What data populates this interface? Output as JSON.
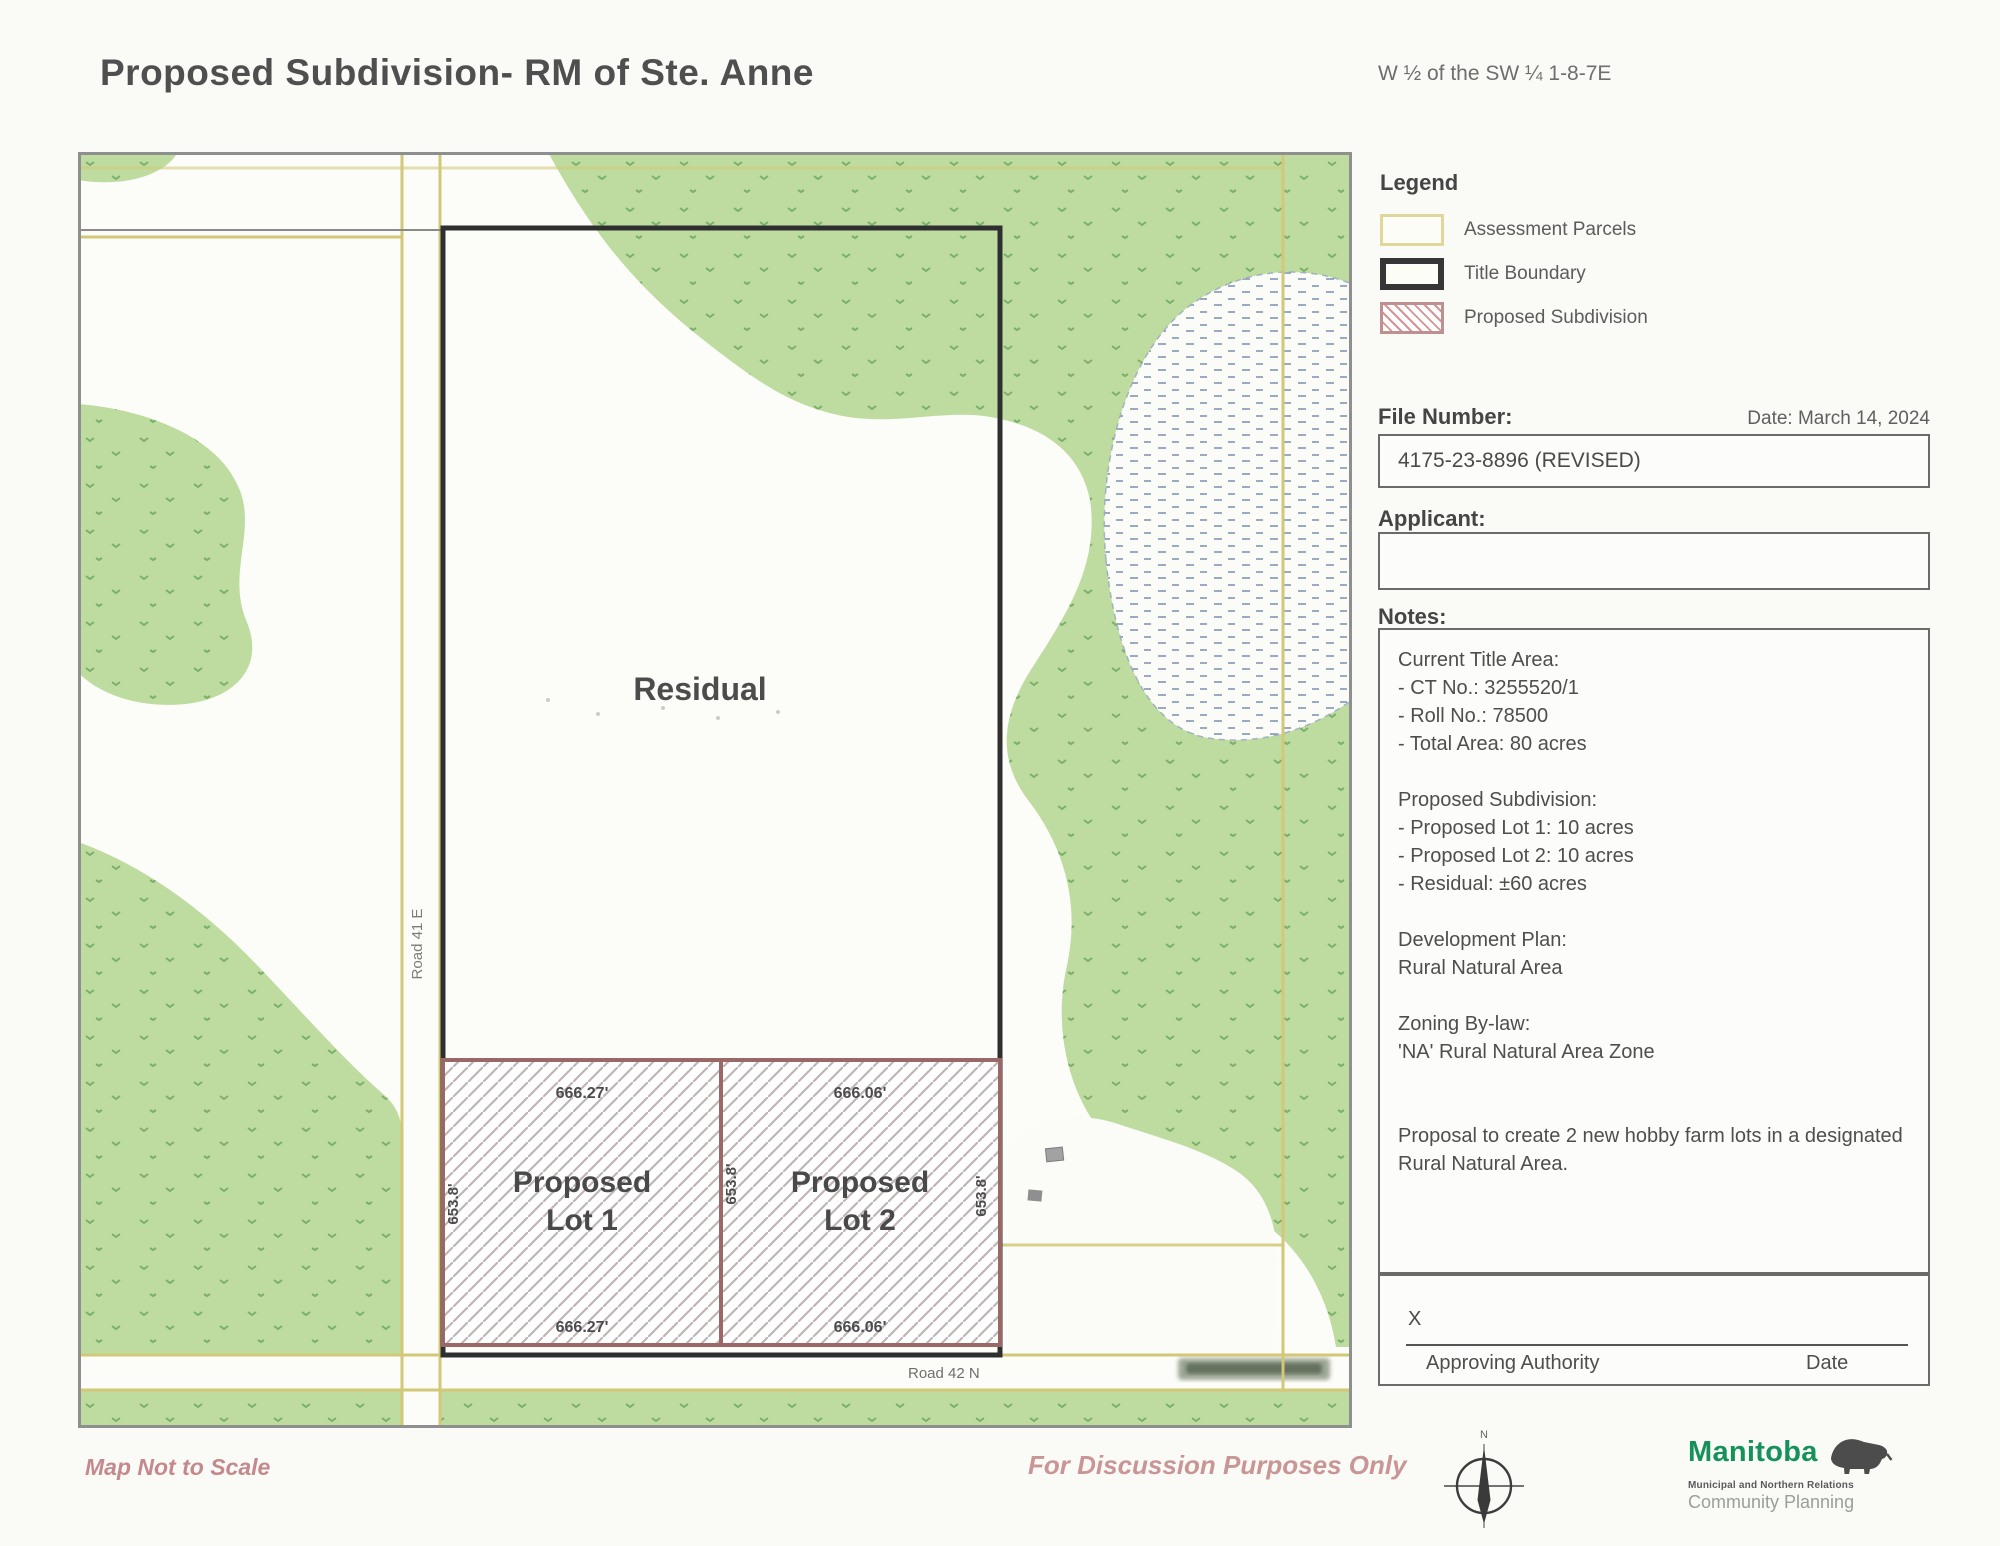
{
  "page": {
    "title": "Proposed Subdivision- RM of Ste. Anne",
    "legal_description": "W ½ of the SW ¼ 1-8-7E",
    "footer_left": "Map Not to Scale",
    "footer_center": "For Discussion Purposes Only"
  },
  "legend": {
    "heading": "Legend",
    "items": [
      {
        "label": "Assessment Parcels"
      },
      {
        "label": "Title Boundary"
      },
      {
        "label": "Proposed Subdivision"
      }
    ]
  },
  "file_info": {
    "label": "File Number:",
    "date": "Date: March 14, 2024",
    "value": "4175-23-8896 (REVISED)"
  },
  "applicant": {
    "label": "Applicant:",
    "value": ""
  },
  "notes": {
    "label": "Notes:",
    "lines": [
      "Current Title Area:",
      "- CT No.: 3255520/1",
      "- Roll No.: 78500",
      "- Total Area: 80 acres",
      "",
      "Proposed Subdivision:",
      "- Proposed Lot 1: 10 acres",
      "- Proposed Lot 2: 10 acres",
      "- Residual: ±60 acres",
      "",
      "Development Plan:",
      "Rural Natural Area",
      "",
      "Zoning By-law:",
      "'NA' Rural Natural Area Zone",
      "",
      "",
      "Proposal to create 2 new hobby farm lots in a designated Rural Natural Area."
    ]
  },
  "signature": {
    "x": "X",
    "authority": "Approving Authority",
    "date": "Date"
  },
  "map": {
    "residual_label": "Residual",
    "road_41e": "Road 41 E",
    "road_42n": "Road 42 N",
    "lot1": {
      "line1": "Proposed",
      "line2": "Lot 1",
      "width_top": "666.27'",
      "width_bottom": "666.27'",
      "depth_left": "653.8'"
    },
    "lot2": {
      "line1": "Proposed",
      "line2": "Lot 2",
      "width_top": "666.06'",
      "width_bottom": "666.06'",
      "depth_mid": "653.8'",
      "depth_right": "653.8'"
    }
  },
  "compass": {
    "north": "N"
  },
  "logo": {
    "name": "Manitoba",
    "department": "Municipal and Northern Relations",
    "unit": "Community Planning"
  },
  "colors": {
    "vegetation_green": "#bedc9f",
    "tree_speckle_green": "#62a156",
    "parcel_yellow": "#d2c878",
    "title_boundary_black": "#2f2f2f",
    "subdivision_maroon": "#9b6868",
    "legend_hatch_red": "#d49494",
    "marsh_blue": "#8296b2",
    "footer_pink": "#c4898c",
    "manitoba_green": "#17915a"
  }
}
